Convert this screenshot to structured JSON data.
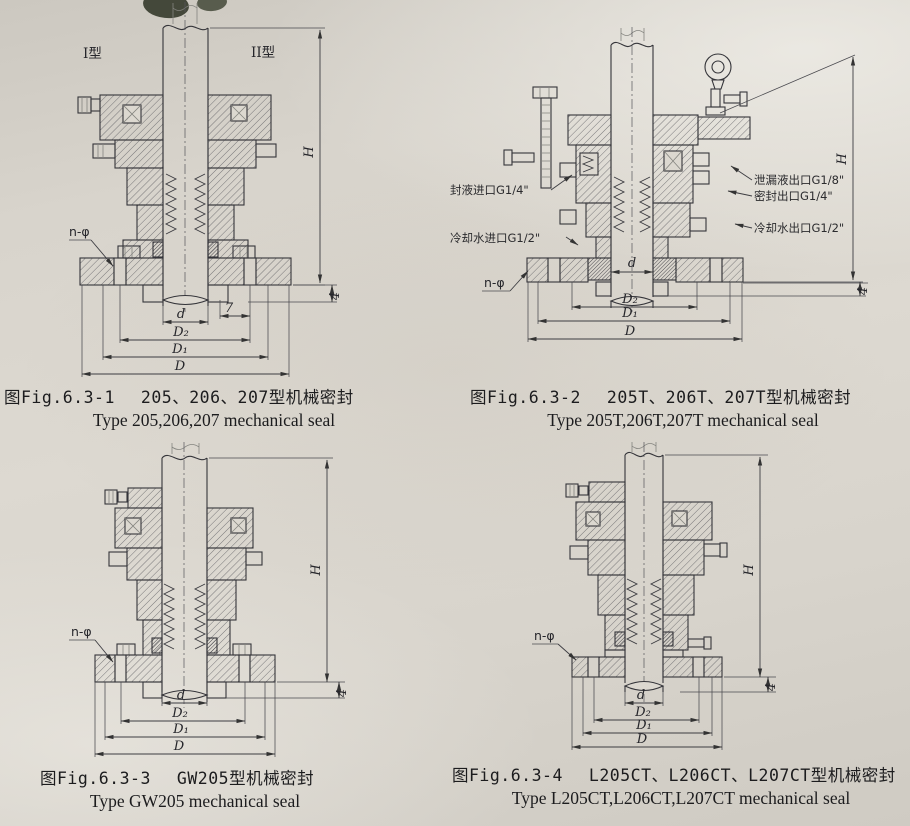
{
  "page": {
    "background": "#d7d3cb"
  },
  "figures": [
    {
      "fig_label": "图Fig.6.3-1",
      "title_zh": "205、206、207型机械密封",
      "title_en": "Type 205,206,207 mechanical seal",
      "labels": {
        "type_left": "I型",
        "type_right": "II型",
        "n_phi": "n-φ",
        "h": "H",
        "d": "d",
        "seven": "7",
        "d2": "D₂",
        "d1": "D₁",
        "dia": "D",
        "four": "4"
      }
    },
    {
      "fig_label": "图Fig.6.3-2",
      "title_zh": "205T、206T、207T型机械密封",
      "title_en": "Type 205T,206T,207T mechanical seal",
      "labels": {
        "n_phi": "n-φ",
        "h": "H",
        "d": "d",
        "d2": "D₂",
        "d1": "D₁",
        "dia": "D",
        "four": "4"
      },
      "ports": {
        "seal_liquid_inlet": "封液进口G1/4\"",
        "cooling_water_inlet": "冷却水进口G1/2\"",
        "leakage_outlet": "泄漏液出口G1/8\"",
        "seal_outlet": "密封出口G1/4\"",
        "cooling_water_outlet": "冷却水出口G1/2\""
      }
    },
    {
      "fig_label": "图Fig.6.3-3",
      "title_zh": "GW205型机械密封",
      "title_en": "Type GW205 mechanical seal",
      "labels": {
        "n_phi": "n-φ",
        "h": "H",
        "d": "d",
        "d2": "D₂",
        "d1": "D₁",
        "dia": "D",
        "four": "4"
      }
    },
    {
      "fig_label": "图Fig.6.3-4",
      "title_zh": "L205CT、L206CT、L207CT型机械密封",
      "title_en": "Type L205CT,L206CT,L207CT mechanical seal",
      "labels": {
        "n_phi": "n-φ",
        "h": "H",
        "d": "d",
        "d2": "D₂",
        "d1": "D₁",
        "dia": "D",
        "four": "4"
      }
    }
  ]
}
